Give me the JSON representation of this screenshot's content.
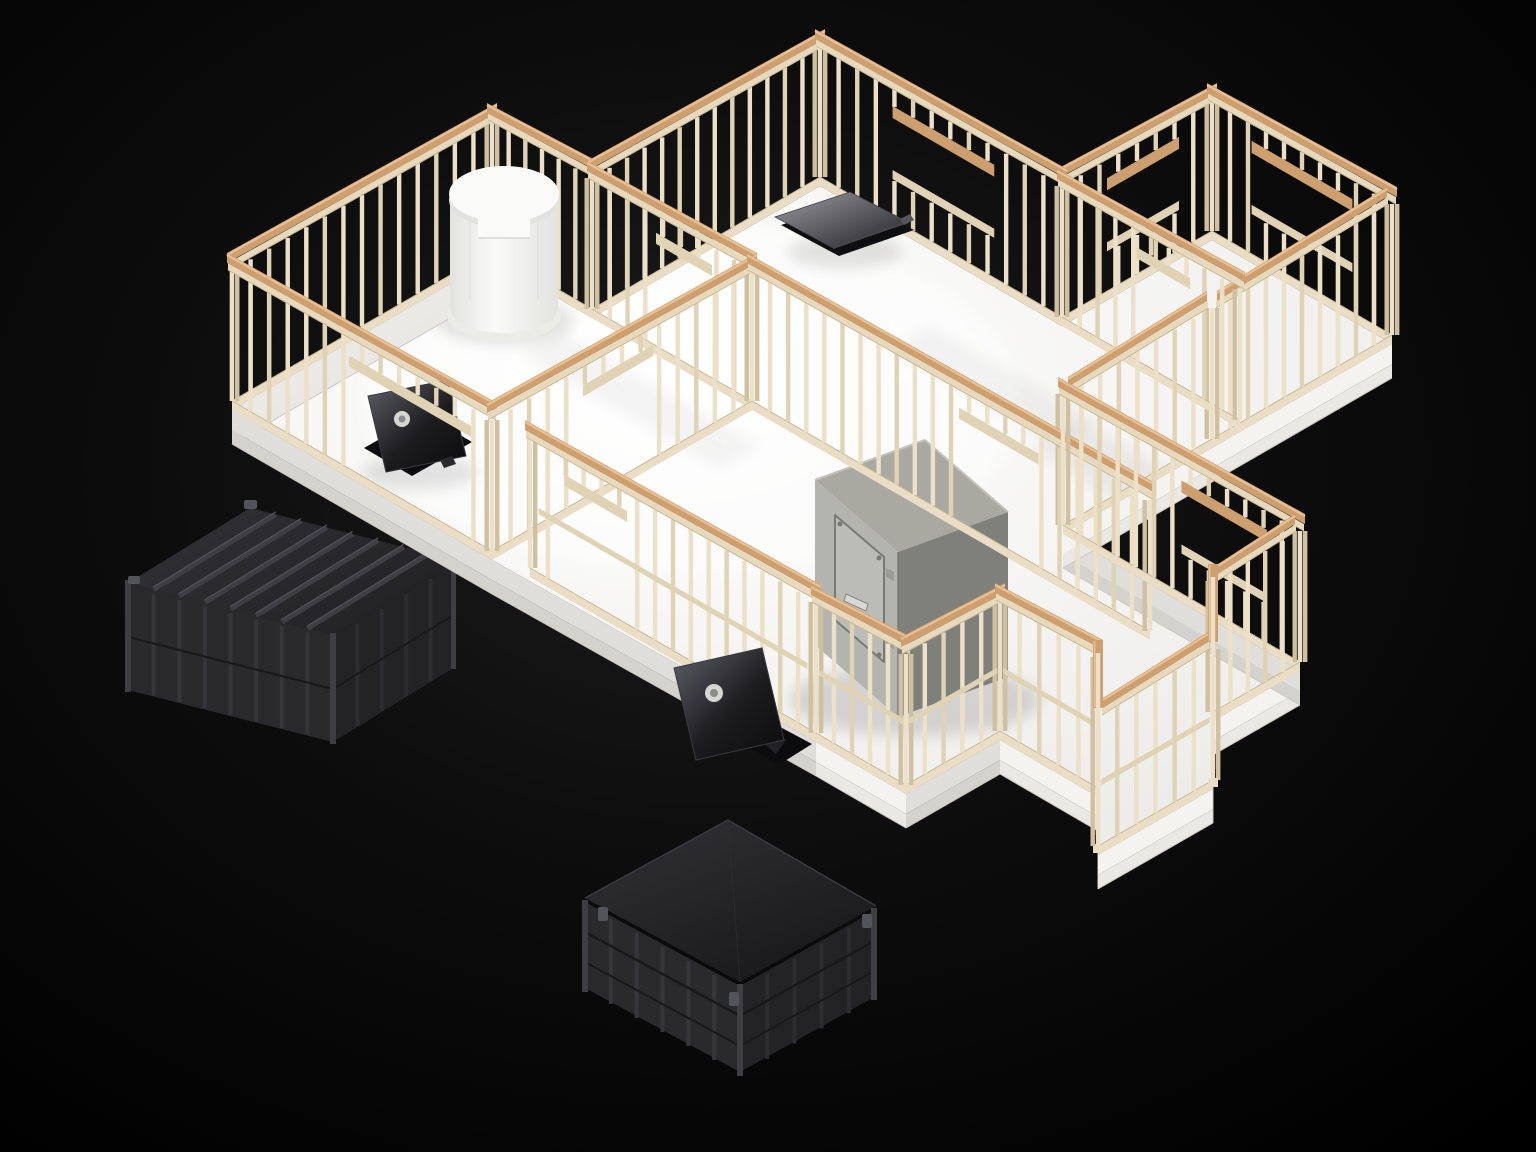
{
  "meta": {
    "title": "3D isometric render — wood-framed house model with storm shelters",
    "alt": "Isometric skeleton framing of a house on a white platform against a black studio background, with a white cylindrical tank, a steel safe room, two opened floor hatches, a roof vent panel and two dark underground shelter boxes"
  },
  "colors": {
    "bgCenter": "#1d1d1d",
    "bgMid": "#0d0d0d",
    "bgEdge": "#000000",
    "stud": "#ece0c8",
    "studAlt": "#e0d2b4",
    "studDark": "#cfc0a2",
    "capTan": "#cd9e6e",
    "capHi": "#e8c093",
    "capShadow": "#b98350",
    "rail": "#e6d9be",
    "plate": "#e9ddc5",
    "plateLine": "#c9b893",
    "floorLight": "#ffffff",
    "floorShade": "#ecebe8",
    "fasciaLit": "#f4f3f0",
    "fasciaShade": "#e0deda",
    "fasciaMid": "#ebe9e5",
    "stepLit": "#eae8e4",
    "stepShade": "#d4d2cd",
    "tankLight": "#fafaf8",
    "tankShade": "#e2e2df",
    "tankBase": "#ebebe8",
    "metalTop": "#a9a9a2",
    "metalFront": "#b4b4ae",
    "metalSide": "#80807b",
    "metalDoor": "#bcbcb6",
    "metalLine": "#7a7a75",
    "metalHandle": "#d8d8d4",
    "shelterTop": "#323236",
    "shelterFace": "#2a2a2d",
    "shelterSide": "#232326",
    "shelterRib": "#3e3e43",
    "shelterHi": "#53535a",
    "shelterDark": "#19191b",
    "hatchLid": "#1c1c1f",
    "hatchSheen": "#60606a",
    "hatchEmblem": "#d6d6d3",
    "hatchOpening": "#0c0c0e",
    "ventLight": "#9a9aa0",
    "ventDark": "#212124"
  },
  "scene": {
    "background": "black studio backdrop with soft central glow",
    "objects": [
      {
        "id": "framed-structure",
        "label": "Wood stud framing",
        "description": "Isometric wood-framed house skeleton with cream studs, tan double top plates, window and door openings, standing on a white floor platform with white skirting"
      },
      {
        "id": "water-tank",
        "label": "White cylindrical tank",
        "description": "Round white tank with overhanging flat lid standing in the rear-left room"
      },
      {
        "id": "roof-vent-panel",
        "label": "Dark vent panel",
        "description": "Low tilted dark metal panel lying on the floor of the top room"
      },
      {
        "id": "floor-hatch-front-left",
        "label": "Open floor hatch",
        "description": "Dark hatch lid with round emblem propped open over a floor opening near the left porch"
      },
      {
        "id": "floor-hatch-south",
        "label": "Open floor hatch",
        "description": "Dark hatch lid with round emblem leaning against the south porch framing"
      },
      {
        "id": "safe-room-box",
        "label": "Steel safe room",
        "description": "Brushed-steel vault box with sealed rounded door, handle and bolts, set in the centre of the framing"
      },
      {
        "id": "shelter-left",
        "label": "Underground shelter (left)",
        "description": "Dark ribbed steel shelter box tucked under the floor slab on the left"
      },
      {
        "id": "shelter-bottom",
        "label": "Underground shelter (bottom)",
        "description": "Dark ribbed steel shelter with tapered top beneath the bay-window floor"
      }
    ]
  }
}
